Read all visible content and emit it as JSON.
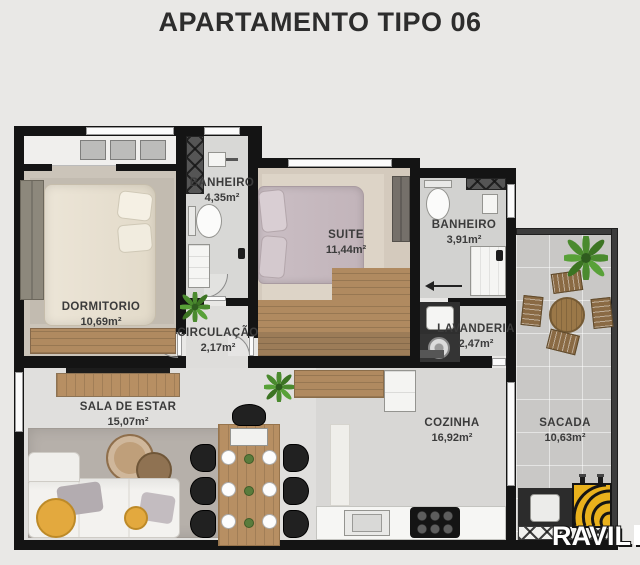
{
  "title": "APARTAMENTO TIPO 06",
  "rooms": [
    {
      "id": "dormitorio",
      "name": "DORMITORIO",
      "area": "10,69m²"
    },
    {
      "id": "banheiro-social",
      "name": "BANHEIRO",
      "area": "4,35m²"
    },
    {
      "id": "suite",
      "name": "SUITE",
      "area": "11,44m²"
    },
    {
      "id": "banheiro-suite",
      "name": "BANHEIRO",
      "area": "3,91m²"
    },
    {
      "id": "circulacao",
      "name": "CIRCULAÇÃO",
      "area": "2,17m²"
    },
    {
      "id": "lavanderia",
      "name": "LAVANDERIA",
      "area": "2,47m²"
    },
    {
      "id": "sala-de-estar",
      "name": "SALA DE ESTAR",
      "area": "15,07m²"
    },
    {
      "id": "cozinha",
      "name": "COZINHA",
      "area": "16,92m²"
    },
    {
      "id": "sacada",
      "name": "SACADA",
      "area": "10,63m²"
    }
  ],
  "logo": {
    "brand": "RAVIL"
  },
  "icons": {
    "plant": "top-view-plant (green starburst)",
    "grill": "yellow-barbecue-grill with black arcs",
    "toilet": "oval-bowl-with-tank",
    "shower": "x-hatched-panel"
  },
  "colors": {
    "background": "#e9e8e6",
    "wall": "#141414",
    "title_text": "#2d2d2d",
    "label_text": "#3b3b3b",
    "brand_yellow": "#e9b11c",
    "plant_green": "#4a8a2e",
    "wood": "#b08a60",
    "sofa_pouf_yellow": "#e3a93e"
  }
}
